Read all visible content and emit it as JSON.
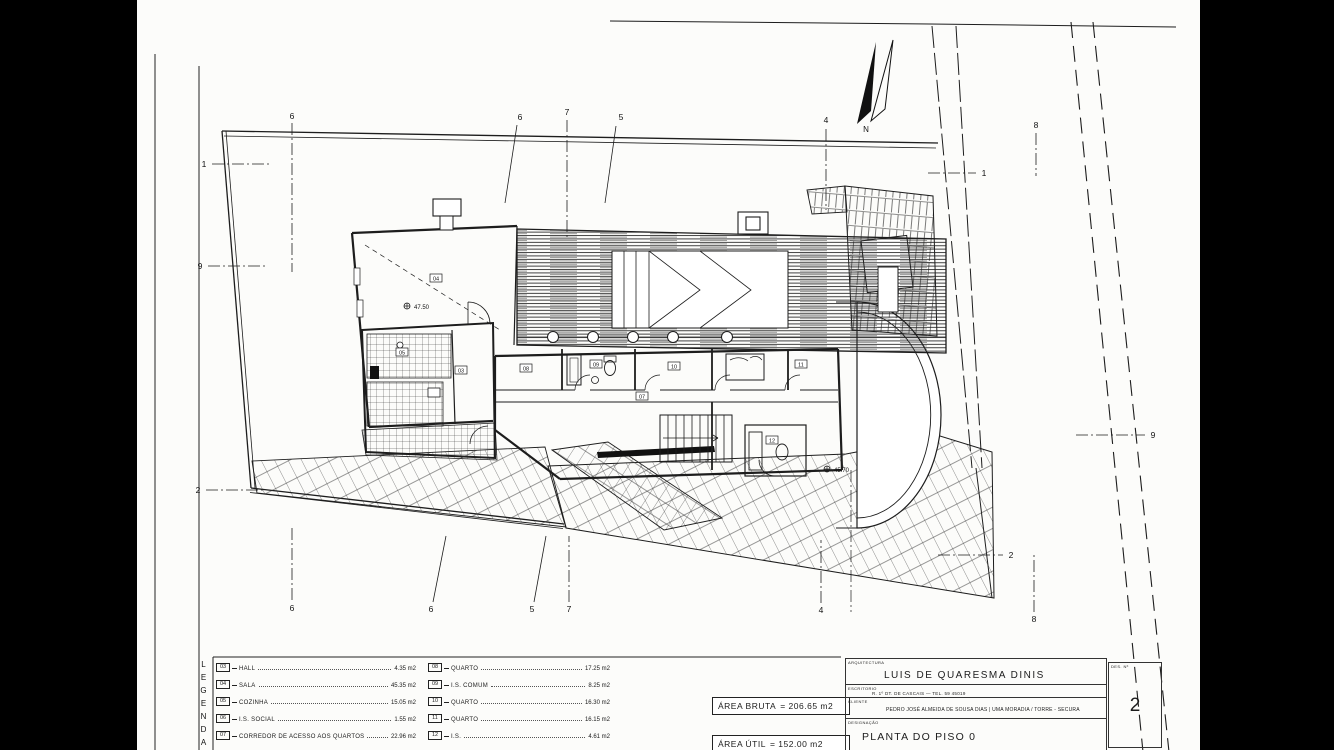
{
  "legend": {
    "title": "LEGENDA",
    "col1": [
      {
        "num": "03",
        "label": "HALL",
        "area": "4.35 m2"
      },
      {
        "num": "04",
        "label": "SALA",
        "area": "45.35 m2"
      },
      {
        "num": "05",
        "label": "COZINHA",
        "area": "15.05 m2"
      },
      {
        "num": "06",
        "label": "I.S. SOCIAL",
        "area": "1.55 m2"
      },
      {
        "num": "07",
        "label": "CORREDOR DE ACESSO AOS QUARTOS",
        "area": "22.96 m2"
      }
    ],
    "col2": [
      {
        "num": "08",
        "label": "QUARTO",
        "area": "17.25 m2"
      },
      {
        "num": "09",
        "label": "I.S. COMUM",
        "area": "8.25 m2"
      },
      {
        "num": "10",
        "label": "QUARTO",
        "area": "16.30 m2"
      },
      {
        "num": "11",
        "label": "QUARTO",
        "area": "16.15 m2"
      },
      {
        "num": "12",
        "label": "I.S.",
        "area": "4.61 m2"
      }
    ]
  },
  "areas": {
    "bruta_label": "ÁREA BRUTA",
    "bruta_value": "= 206.65 m2",
    "util_label": "ÁREA ÚTIL",
    "util_value": "= 152.00 m2"
  },
  "title_block": {
    "architecture_caption": "ARQUITECTURA",
    "architect": "LUIS DE QUARESMA DINIS",
    "office_caption": "ESCRITORIO",
    "office_info": "R. 1º DT. DE CASCAIS — TEL. 59 45019",
    "client_caption": "CLIENTE",
    "client": "PEDRO JOSÉ ALMEIDA DE SOUSA DIAS | UMA MORADIA / TORRE - SECURA",
    "designation_caption": "DESIGNAÇÃO",
    "designation": "PLANTA DO PISO 0",
    "sheet_no_caption": "DES. Nº",
    "sheet_no": "2"
  },
  "plan": {
    "north_label": "N",
    "markers": {
      "top": [
        "6",
        "6",
        "7",
        "5",
        "4",
        "8"
      ],
      "bottom": [
        "6",
        "6",
        "5",
        "7",
        "4",
        "8"
      ],
      "left": [
        "1",
        "9",
        "2"
      ],
      "right": [
        "1",
        "9",
        "2"
      ]
    },
    "levels": [
      {
        "label": "47.50"
      },
      {
        "label": "45.70"
      }
    ],
    "room_tags": [
      {
        "num": "03"
      },
      {
        "num": "04"
      },
      {
        "num": "05"
      },
      {
        "num": "07"
      },
      {
        "num": "08"
      },
      {
        "num": "09"
      },
      {
        "num": "10"
      },
      {
        "num": "11"
      },
      {
        "num": "12"
      }
    ]
  }
}
